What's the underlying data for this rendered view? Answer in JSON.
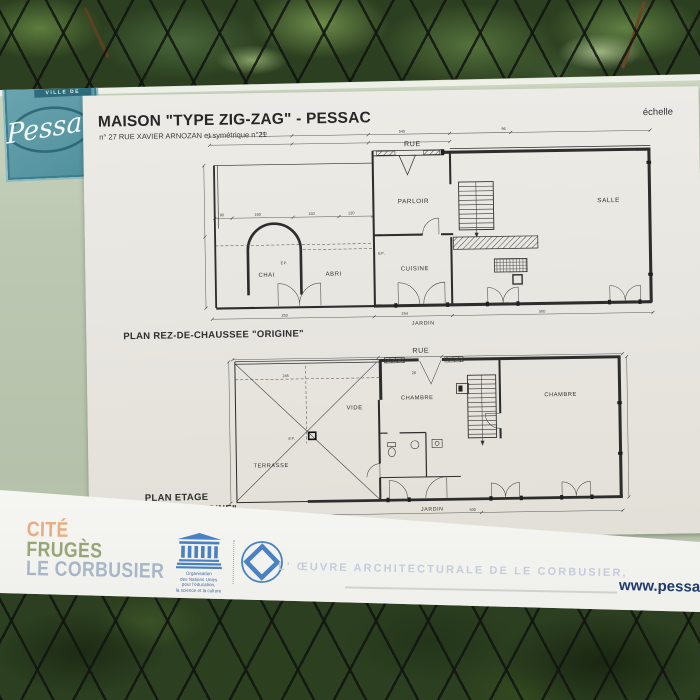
{
  "logo": {
    "ville": "VILLE DE",
    "name": "Pessac"
  },
  "sheet": {
    "title": "MAISON \"TYPE ZIG-ZAG\" - PESSAC",
    "subtitle": "n° 27 RUE XAVIER ARNOZAN et symétrique n°21",
    "scale_label": "échelle",
    "plan1": {
      "caption": "PLAN REZ-DE-CHAUSSEE \"ORIGINE\"",
      "labels": {
        "rue": "RUE",
        "parloir": "PARLOIR",
        "salle": "SALLE",
        "chai": "CHAI",
        "abri": "ABRI",
        "cuisine": "CUISINE",
        "ep": "EP.",
        "jardin": "JARDIN"
      }
    },
    "plan2": {
      "caption_line1": "PLAN ETAGE",
      "caption_line2": "\"ORIGINE\"",
      "labels": {
        "rue": "RUE",
        "vide": "VIDE",
        "chambre": "CHAMBRE",
        "ep": "EP.",
        "terrasse": "TERRASSE",
        "jardin": "JARDIN"
      }
    },
    "dims": [
      "510",
      "545",
      "96",
      "90",
      "160",
      "150",
      "120",
      "253",
      "254",
      "500",
      "245",
      "26"
    ]
  },
  "footer": {
    "site": [
      "CITÉ",
      "FRUGÈS",
      "LE CORBUSIER"
    ],
    "unesco_lines": [
      "Organisation",
      "des Nations Unies",
      "pour l'éducation,",
      "la science et la culture"
    ],
    "heritage_text": "L' ŒUVRE ARCHITECTURALE DE LE CORBUSIER,",
    "website": "www.pessac."
  },
  "colors": {
    "sign_green": "#b9c4ae",
    "logo_teal": "#4f8f9c",
    "unesco_blue": "#4a81c4",
    "cite_orange": "#ecaa80",
    "fruges_olive": "#97a577",
    "corbusier_gray": "#a8b6c6",
    "website_navy": "#1e3a6e"
  }
}
